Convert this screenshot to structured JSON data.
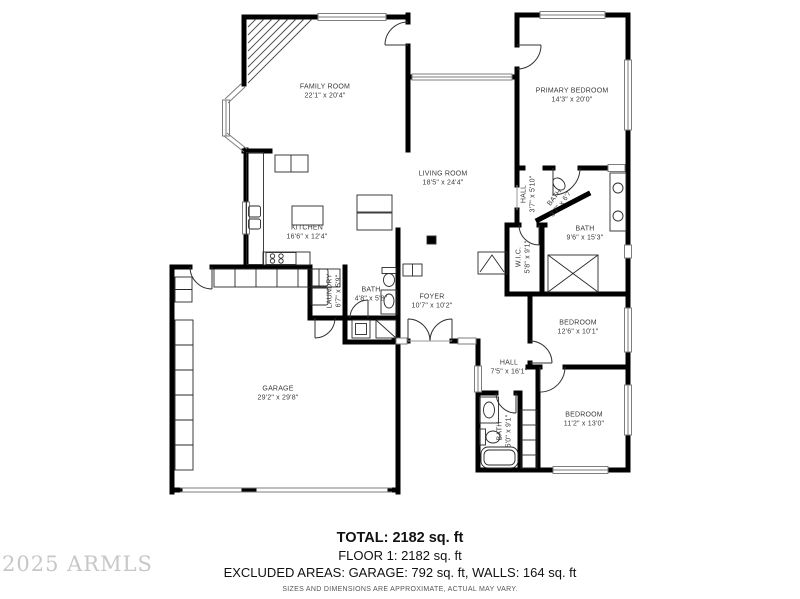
{
  "watermark": "2025 ARMLS",
  "footer": {
    "total": "TOTAL: 2182 sq. ft",
    "floor1": "FLOOR 1: 2182 sq. ft",
    "excluded": "EXCLUDED AREAS: GARAGE: 792 sq. ft, WALLS: 164 sq. ft",
    "disclaimer": "SIZES AND DIMENSIONS ARE APPROXIMATE, ACTUAL MAY VARY."
  },
  "rooms": [
    {
      "name": "FAMILY ROOM",
      "dims": "22'1\" x 20'4\""
    },
    {
      "name": "PRIMARY BEDROOM",
      "dims": "14'3\" x 20'0\""
    },
    {
      "name": "LIVING ROOM",
      "dims": "18'5\" x 24'4\""
    },
    {
      "name": "KITCHEN",
      "dims": "16'6\" x 12'4\""
    },
    {
      "name": "HALL",
      "dims": "3'7\" x 5'10\""
    },
    {
      "name": "BATH",
      "dims": "3'7\" x 6'7\""
    },
    {
      "name": "BATH",
      "dims": "9'6\" x 15'3\""
    },
    {
      "name": "W.I.C.",
      "dims": "5'8\" x 9'1\""
    },
    {
      "name": "LAUNDRY",
      "dims": "6'7\" x 5'9\""
    },
    {
      "name": "BATH",
      "dims": "4'8\" x 5'8\""
    },
    {
      "name": "FOYER",
      "dims": "10'7\" x 10'2\""
    },
    {
      "name": "GARAGE",
      "dims": "29'2\" x 29'8\""
    },
    {
      "name": "BEDROOM",
      "dims": "12'6\" x 10'1\""
    },
    {
      "name": "HALL",
      "dims": "7'5\" x 16'1\""
    },
    {
      "name": "BEDROOM",
      "dims": "11'2\" x 13'0\""
    },
    {
      "name": "BATH",
      "dims": "5'0\" x 9'1\""
    }
  ]
}
